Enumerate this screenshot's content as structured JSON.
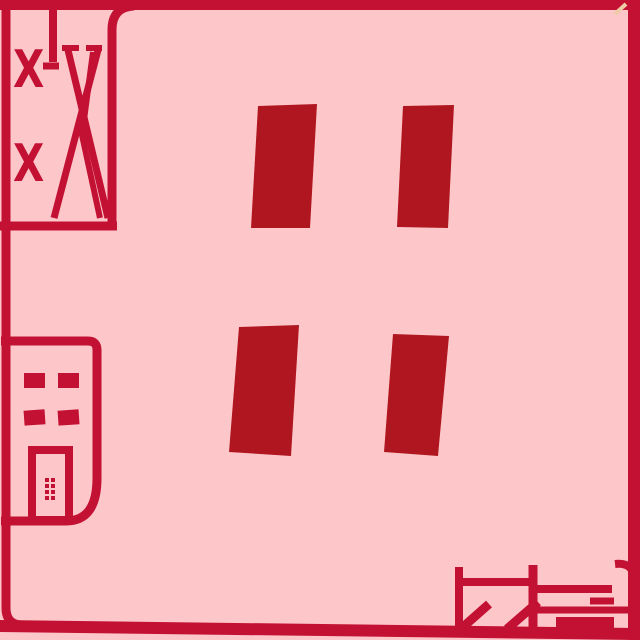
{
  "page": {
    "description": "Abstract red line-art card on pink background",
    "background_color": "#fdc7ca"
  },
  "colors": {
    "background": "#fdc7ca",
    "ink": "#c31134",
    "bar_fill": "#b0161f",
    "corner_notch": "#eecaa6"
  },
  "frame": {
    "icon": "rounded-border-frame"
  },
  "stroke_panel": {
    "icon": "crossed-strokes-icon",
    "x_marks": [
      "X",
      "X"
    ]
  },
  "bars": {
    "icon": "quote-bars-icon",
    "count": "4"
  },
  "building": {
    "icon": "building-icon",
    "window_count": "4",
    "door_count": "1"
  },
  "signature": {
    "icon": "signature-glyphs-icon"
  }
}
